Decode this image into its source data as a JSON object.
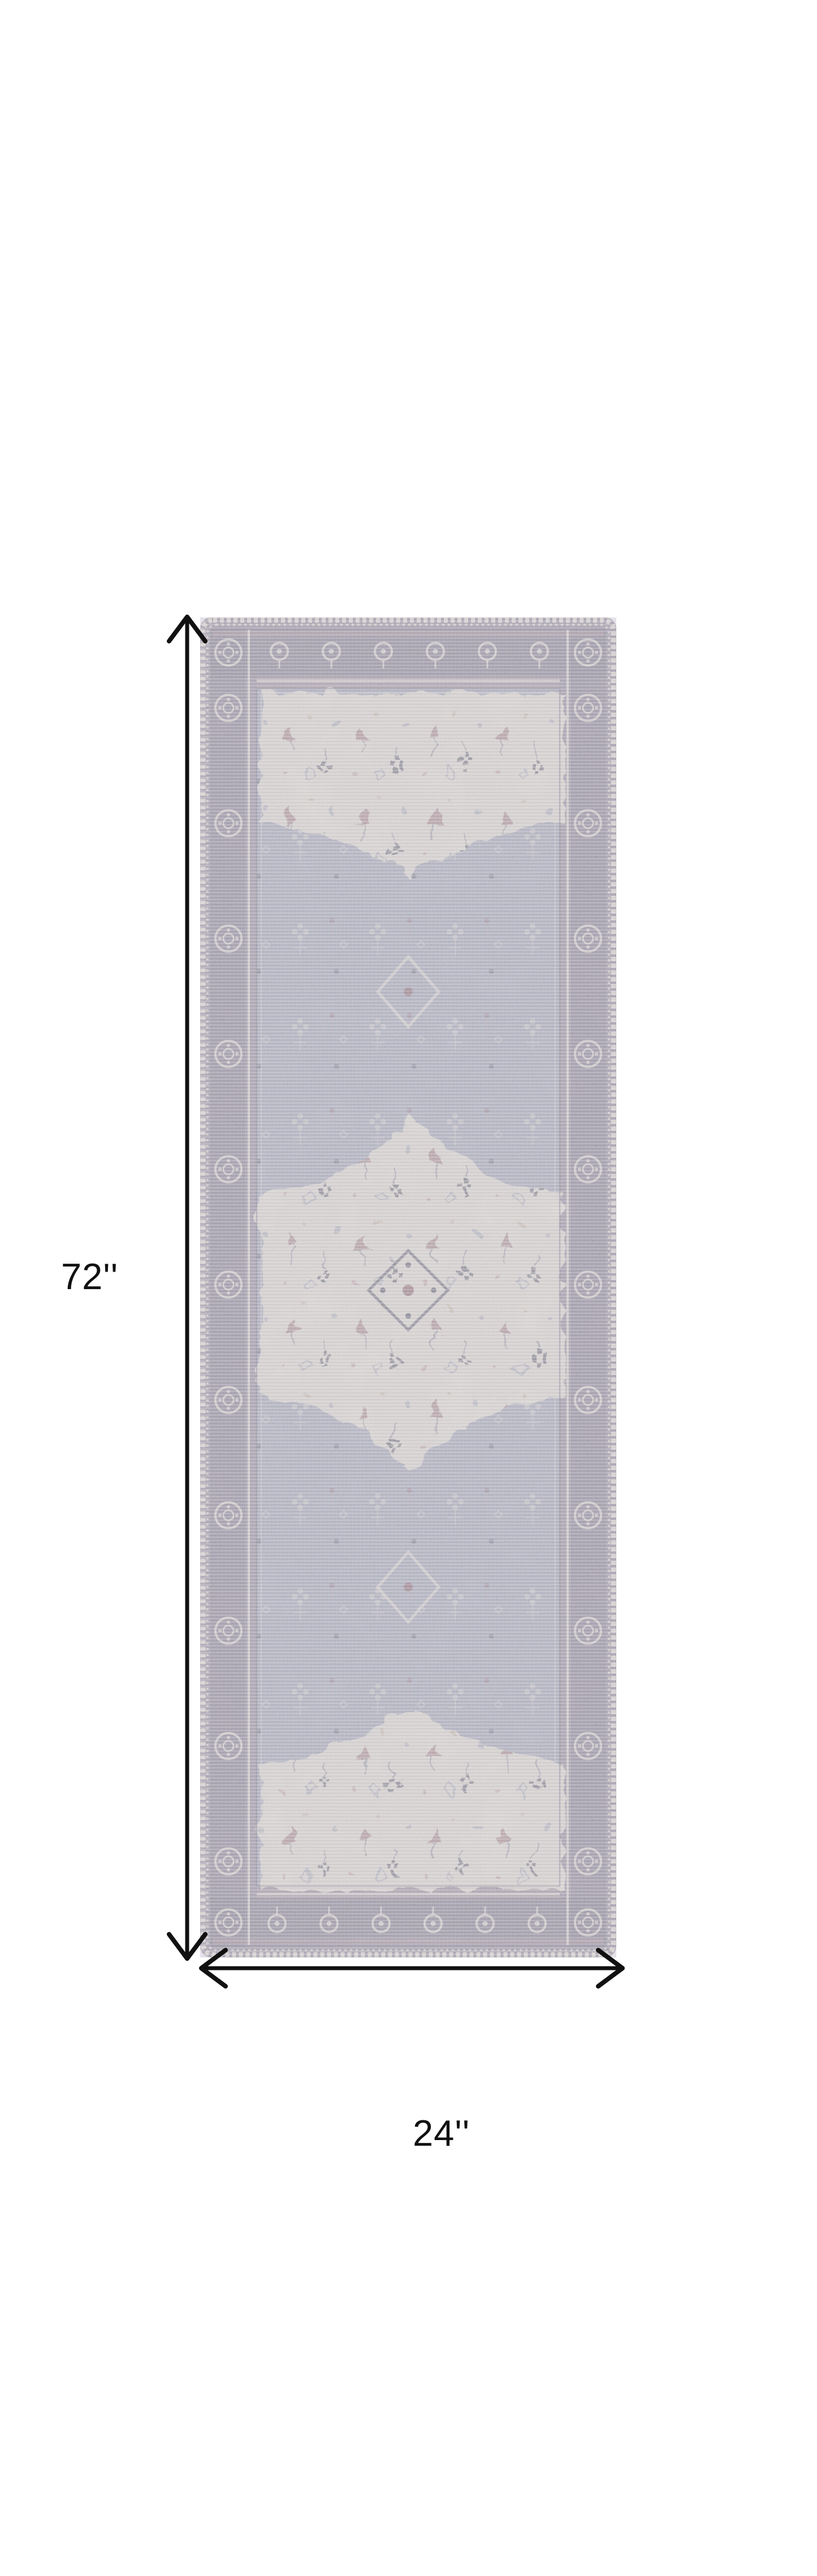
{
  "figure": {
    "name": "rug-dimension-diagram",
    "subject": "Vintage medallion runner rug, grey lavender and ivory with mauve accents",
    "background": "#ffffff"
  },
  "dimensions": {
    "height_label": "72''",
    "width_label": "24''"
  },
  "colors": {
    "bg": "#ffffff",
    "label": "#111111",
    "arrow": "#111111",
    "ivory": "#e9e4d7",
    "stitch": "#ece7da",
    "field": "#a6abbc",
    "field-light": "#b7bbc8",
    "border": "#968fa0",
    "border-dark": "#7a7489",
    "pink": "#c2a0a8",
    "wine": "#8a5a68",
    "navy": "#42455c",
    "tan": "#cbb9a2"
  }
}
